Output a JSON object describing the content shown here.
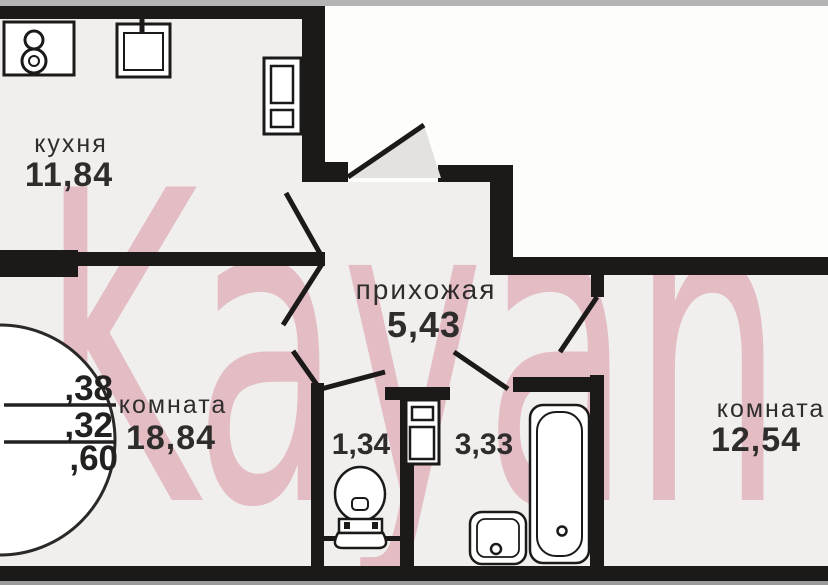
{
  "watermark": {
    "text": "Kayan",
    "color": "#f2c9d3"
  },
  "rooms": {
    "kitchen": {
      "label": "кухня",
      "area": "11,84"
    },
    "hallway": {
      "label": "прихожая",
      "area": "5,43"
    },
    "room_left": {
      "label": "комната",
      "area": "18,84"
    },
    "wc": {
      "area": "1,34"
    },
    "bathroom": {
      "area": "3,33"
    },
    "room_right": {
      "label": "комната",
      "area": "12,54"
    }
  },
  "area_circle": {
    "line1": ",38",
    "line2": ",32",
    "line3": ",60"
  },
  "colors": {
    "wall": "#1c1a19",
    "floor": "#f0efed",
    "outside": "#fdfdfc",
    "top_strip": "#b4b4b4",
    "bottom_strip": "#9a9a9a",
    "door_swing_fill": "#e3e2e0",
    "label_text": "#2f2d2b",
    "watermark_pink": "#f2c9d3"
  },
  "icons": {
    "stove": "stove-icon",
    "kitchen_sink": "kitchen-sink-icon",
    "fridge": "fridge-icon",
    "water_heater": "water-heater-icon",
    "toilet": "toilet-icon",
    "washbasin": "washbasin-icon",
    "bathtub": "bathtub-icon"
  }
}
